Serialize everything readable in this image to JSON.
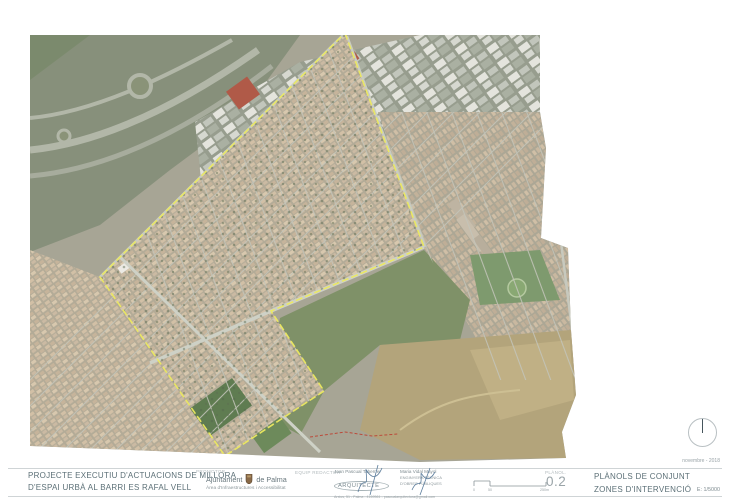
{
  "sheet": {
    "date": "novembre - 2018",
    "project": {
      "line1": "PROJECTE EXECUTIU D'ACTUACIONS DE MILLORA",
      "line2": "D'ESPAI URBÀ AL BARRI ES RAFAL VELL"
    },
    "promotor": {
      "label": "PROMOTOR",
      "org1": "Ajuntament",
      "org2": "de Palma",
      "dept": "Àrea d'Infraestructures i Accessibilitat"
    },
    "equip": {
      "label": "EQUIP REDACTOR",
      "m1": {
        "name": "Joan Pascual Taberner",
        "role": "ARQUITECTE",
        "contact": "Arxius, 51 - Palma - 4169561 - pascualarquitectura@gmail.com"
      },
      "m2": {
        "name": "Maria Vidal Mayol",
        "role1": "ENGINYERA TÈCNICA",
        "role2": "D'OBRES PÚBLIQUES"
      }
    },
    "scalebar": {
      "t0": "0",
      "t1": "50",
      "t2": "250m"
    },
    "planol": {
      "label": "PLÀNOL.",
      "number": "0.2"
    },
    "titleblock": {
      "line1": "PLÀNOLS DE CONJUNT",
      "line2": "ZONES D'INTERVENCIÓ",
      "scale": "E: 1/5000"
    }
  },
  "map": {
    "boundary_points": "345,33 424,247 271,311 324,391 225,456 100,277",
    "boundary_color": "#ece95f",
    "red_line_points": "310,437 345,432 372,436 398,434",
    "red_line_color": "#bb4a3a"
  }
}
